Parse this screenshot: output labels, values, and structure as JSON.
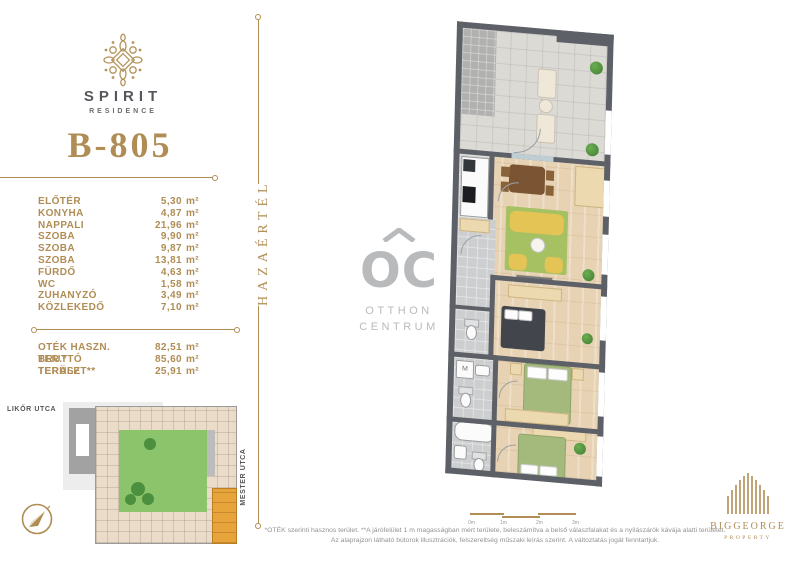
{
  "brand": {
    "name": "SPIRIT",
    "subtitle": "RESIDENCE"
  },
  "unit_id": "B-805",
  "tagline": "HAZAÉRTÉL",
  "areas": {
    "unit": "m²",
    "rooms": [
      {
        "label": "ELŐTÉR",
        "value": "5,30"
      },
      {
        "label": "KONYHA",
        "value": "4,87"
      },
      {
        "label": "NAPPALI",
        "value": "21,96"
      },
      {
        "label": "SZOBA",
        "value": "9,90"
      },
      {
        "label": "SZOBA",
        "value": "9,87"
      },
      {
        "label": "SZOBA",
        "value": "13,81"
      },
      {
        "label": "FÜRDŐ",
        "value": "4,63"
      },
      {
        "label": "WC",
        "value": "1,58"
      },
      {
        "label": "ZUHANYZÓ",
        "value": "3,49"
      },
      {
        "label": "KÖZLEKEDŐ",
        "value": "7,10"
      }
    ],
    "totals": [
      {
        "label": "OTÉK HASZN. TER.*",
        "value": "82,51"
      },
      {
        "label": "BRUTTÓ TERÜLET**",
        "value": "85,60"
      },
      {
        "label": "TERASZ",
        "value": "25,91"
      }
    ]
  },
  "site_plan": {
    "street_top": "LIKŐR UTCA",
    "street_right": "MESTER UTCA"
  },
  "agency": {
    "initials": "OC",
    "line1": "OTTHON",
    "line2": "CENTRUM"
  },
  "developer": {
    "name": "BIGGEORGE",
    "subtitle": "PROPERTY"
  },
  "floor_plan": {
    "washer_label": "M"
  },
  "scale_bar": {
    "labels": [
      "0m",
      "1m",
      "2m",
      "3m"
    ]
  },
  "footnotes": {
    "line1": "*OTÉK szerinti hasznos terület.  **A járófelület 1 m magasságban mért területe, beleszámítva a belső válaszfalakat és a nyílászárók kávája alatti területet.",
    "line2": "Az alaprajzon látható bútorok illusztrációk, felszereltség műszaki leírás szerint. A változtatás jogát fenntartjuk."
  },
  "colors": {
    "gold": "#b08d55",
    "dark_text": "#55575c",
    "logo_gray": "#b8babc",
    "wall": "#5d6167",
    "courtyard_green": "#8cc46b",
    "unit_highlight": "#e7a43b"
  }
}
